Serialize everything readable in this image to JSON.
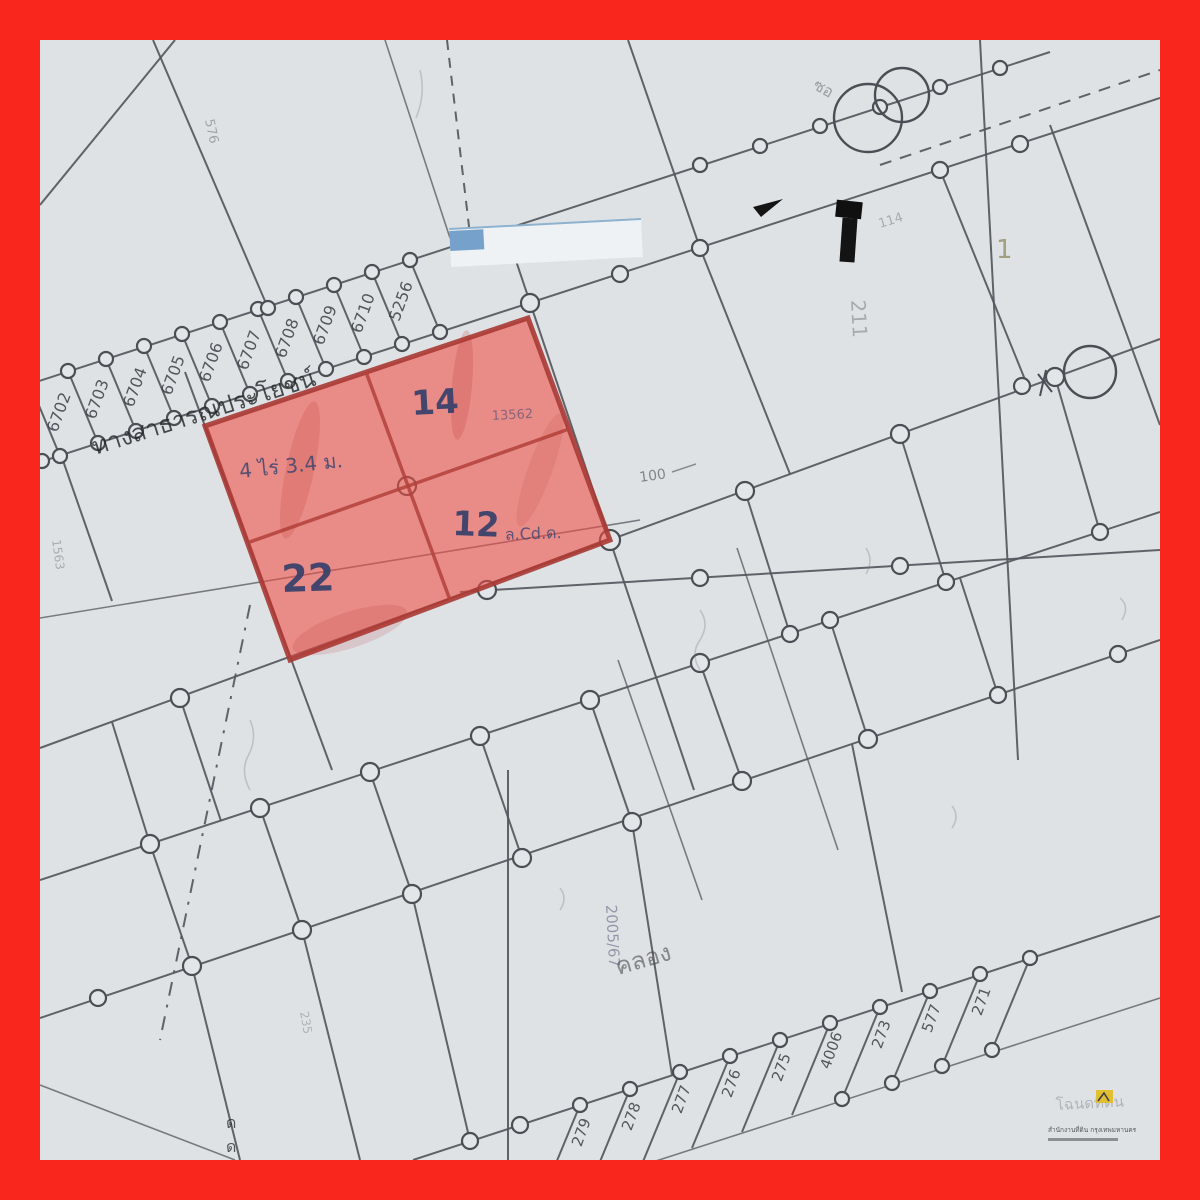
{
  "palette": {
    "frame_color": "#f9261d",
    "paper_color": "#dfe2e5",
    "ink_color": "#54575d",
    "highlight_color": "#ef4c44",
    "stamp_ink_color": "#333e6b"
  },
  "highlight": {
    "description": "red marked group of four land plots",
    "stamp_top": "14",
    "note_top": "13562",
    "stamp_mid": "12",
    "note_mid": "ล.Cd.ด.",
    "stamp_bottom": "22",
    "area_note": "4 ไร่ 3.4 ม."
  },
  "labels": {
    "road": "ทางสาธารณประโยชน์",
    "canal": "คลอง",
    "soi": "2005/67",
    "hundred": "100",
    "col211": "211",
    "one": "1",
    "nw_corner": "576",
    "left_edge": "1563",
    "bottom_left": "235",
    "dd1": "ด",
    "dd2": "ด",
    "survey": "114",
    "near_circles": "ซอ"
  },
  "strips": {
    "northwest": {
      "labels": [
        "6702",
        "6703",
        "6704",
        "6705",
        "6706",
        "6707",
        "6708",
        "6709",
        "6710",
        "5256"
      ]
    },
    "southeast": {
      "labels": [
        "279",
        "278",
        "277",
        "276",
        "275",
        "4006",
        "273",
        "577",
        "271"
      ]
    }
  },
  "watermark": {
    "title": "โฉนดที่ดิน",
    "line": "สำนักงานที่ดิน กรุงเทพมหานคร"
  }
}
